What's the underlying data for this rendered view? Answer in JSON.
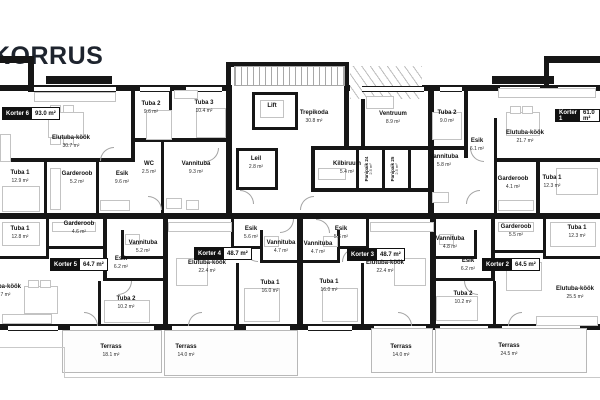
{
  "title": "KORRUS",
  "apartments": {
    "k6": {
      "label": "Korter 6",
      "area": "93.0 m²",
      "rooms": {
        "elutuba": {
          "n": "Elutuba-köök",
          "a": "30.7 m²"
        },
        "tuba1": {
          "n": "Tuba 1",
          "a": "12.9 m²"
        },
        "garderoob": {
          "n": "Garderoob",
          "a": "5.2 m²"
        },
        "esik": {
          "n": "Esik",
          "a": "9.6 m²"
        },
        "tuba2": {
          "n": "Tuba 2",
          "a": "9.6 m²"
        },
        "tuba3": {
          "n": "Tuba 3",
          "a": "10.4 m²"
        },
        "wc": {
          "n": "WC",
          "a": "2.5 m²"
        },
        "vannituba": {
          "n": "Vannituba",
          "a": "9.3 m²"
        },
        "leil": {
          "n": "Leil",
          "a": "2.8 m²"
        }
      }
    },
    "k1": {
      "label": "Korter 1",
      "area": "61.0 m²",
      "rooms": {
        "tuba2": {
          "n": "Tuba 2",
          "a": "9.0 m²"
        },
        "esik": {
          "n": "Esik",
          "a": "6.1 m²"
        },
        "elutuba": {
          "n": "Elutuba-köök",
          "a": "21.7 m²"
        },
        "vannituba": {
          "n": "Vannituba",
          "a": "5.8 m²"
        },
        "garderoob": {
          "n": "Garderoob",
          "a": "4.1 m²"
        },
        "tuba1": {
          "n": "Tuba 1",
          "a": "12.3 m²"
        }
      }
    },
    "k5": {
      "label": "Korter 5",
      "area": "64.7 m²",
      "rooms": {
        "tuba1": {
          "n": "Tuba 1",
          "a": "12.8 m²"
        },
        "garderoob": {
          "n": "Garderoob",
          "a": "4.6 m²"
        },
        "vannituba": {
          "n": "Vannituba",
          "a": "5.2 m²"
        },
        "esik": {
          "n": "Esik",
          "a": "6.2 m²"
        },
        "elutuba": {
          "n": "Elutuba-köök",
          "a": "25.7 m²"
        },
        "tuba2": {
          "n": "Tuba 2",
          "a": "10.2 m²"
        }
      }
    },
    "k4": {
      "label": "Korter 4",
      "area": "48.7 m²",
      "rooms": {
        "esik": {
          "n": "Esik",
          "a": "5.6 m²"
        },
        "vannituba": {
          "n": "Vannituba",
          "a": "4.7 m²"
        },
        "elutuba": {
          "n": "Elutuba-köök",
          "a": "22.4 m²"
        },
        "tuba1": {
          "n": "Tuba 1",
          "a": "16.0 m²"
        }
      }
    },
    "k3": {
      "label": "Korter 3",
      "area": "48.7 m²",
      "rooms": {
        "esik": {
          "n": "Esik",
          "a": "5.6 m²"
        },
        "vannituba": {
          "n": "Vannituba",
          "a": "4.7 m²"
        },
        "elutuba": {
          "n": "Elutuba-köök",
          "a": "22.4 m²"
        },
        "tuba1": {
          "n": "Tuba 1",
          "a": "16.0 m²"
        }
      }
    },
    "k2": {
      "label": "Korter 2",
      "area": "64.5 m²",
      "rooms": {
        "garderoob": {
          "n": "Garderoob",
          "a": "5.5 m²"
        },
        "tuba1": {
          "n": "Tuba 1",
          "a": "12.3 m²"
        },
        "vannituba": {
          "n": "Vannituba",
          "a": "4.8 m²"
        },
        "esik": {
          "n": "Esik",
          "a": "6.2 m²"
        },
        "tuba2": {
          "n": "Tuba 2",
          "a": "10.2 m²"
        },
        "elutuba": {
          "n": "Elutuba-köök",
          "a": "25.5 m²"
        }
      }
    }
  },
  "common": {
    "lift": "Lift",
    "trepikoda": {
      "n": "Trepikoda",
      "a": "30.8 m²"
    },
    "ventruum": {
      "n": "Ventruum",
      "a": "8.9 m²"
    },
    "kilbiruum": {
      "n": "Kilbiruum",
      "a": "5.4 m²"
    },
    "panipaik24": {
      "n": "Panipaik 24",
      "a": "2.5 m²"
    },
    "panipaik25": {
      "n": "Panipaik 25",
      "a": "2.5 m²"
    }
  },
  "terraces": [
    {
      "n": "Terrass",
      "a": "18.1 m²"
    },
    {
      "n": "Terrass",
      "a": "14.0 m²"
    },
    {
      "n": "Terrass",
      "a": "14.0 m²"
    },
    {
      "n": "Terrass",
      "a": "24.5 m²"
    }
  ]
}
